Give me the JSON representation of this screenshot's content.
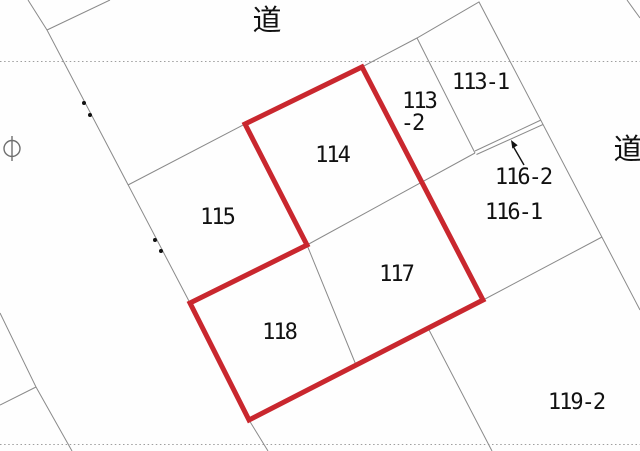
{
  "map": {
    "type": "cadastral-parcel-map",
    "road_label_top": "道",
    "road_label_right": "道",
    "parcels": {
      "p113_1": "113-1",
      "p113_2_line1": "113",
      "p113_2_line2": "-2",
      "p114": "114",
      "p115": "115",
      "p116_2": "116-2",
      "p116_1": "116-1",
      "p117": "117",
      "p118": "118",
      "p119_2": "119-2"
    },
    "highlighted_parcels": [
      "114",
      "117",
      "118"
    ],
    "colors": {
      "highlight_red": "#c9272e",
      "boundary_gray": "#8a8a8a",
      "text_black": "#111111",
      "background": "#fefefe"
    }
  },
  "geometry": {
    "red_outline": "M245,124 L362,67 L483,300 L249,420 L190,303 L307,245 Z",
    "boundary_lines": "M28,0 L47,30 L190,303 M47,30 L110,0 M128,185 L245,124 M0,313 L36,387 L72,451 M36,387 L0,405 M249,420 L268,451 M428,328 L492,451 M307,245 L475,153 M307,245 L356,365 M362,67 L417,38 L479,2 L640,310 M417,38 L475,153 M475,151 L541,120 M476.5,154.5 L543,124.5 M602,237 L485,299 M627,0 L640,18",
    "dotted_sheet_lines": "M0,61.5 H640 M0,444.5 H640",
    "survey_dots": "M82,103 a2,2 0 1 0 4,0 a2,2 0 1 0 -4,0 M88,115 a2,2 0 1 0 4,0 a2,2 0 1 0 -4,0 M153,240 a2,2 0 1 0 4,0 a2,2 0 1 0 -4,0 M159,251 a2,2 0 1 0 4,0 a2,2 0 1 0 -4,0",
    "pole_symbol": "M12,136 V161 M4,148.5 a8,8 0 1 0 16,0 a8,8 0 1 0 -16,0",
    "arrow_line": "M524,165 L513,146",
    "arrow_head": "M511,140 L517.7,145.3 L512.3,148.5 Z"
  }
}
